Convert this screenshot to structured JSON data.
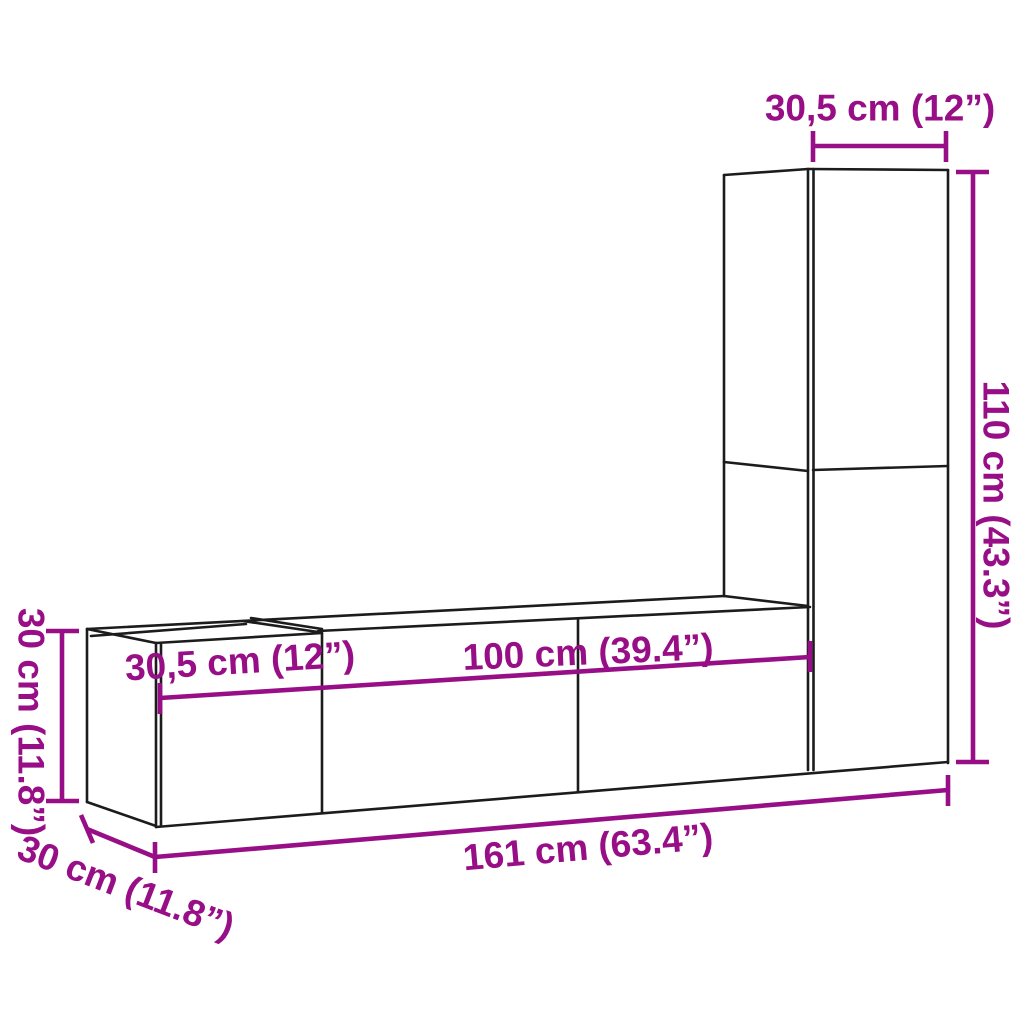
{
  "colors": {
    "background": "#ffffff",
    "outline": "#1c1c1c",
    "dimension": "#970E86"
  },
  "measurements": {
    "upper_unit_width": {
      "text": "30,5 cm (12”)"
    },
    "tall_unit_height": {
      "text": "110 cm (43.3”)"
    },
    "left_unit_height": {
      "text": "30 cm (11.8”)"
    },
    "left_unit_width": {
      "text": "30,5 cm (12”)"
    },
    "center_unit_width": {
      "text": "100 cm (39.4”)"
    },
    "total_width": {
      "text": "161 cm (63.4”)"
    },
    "unit_depth": {
      "text": "30 cm (11.8”)"
    }
  }
}
